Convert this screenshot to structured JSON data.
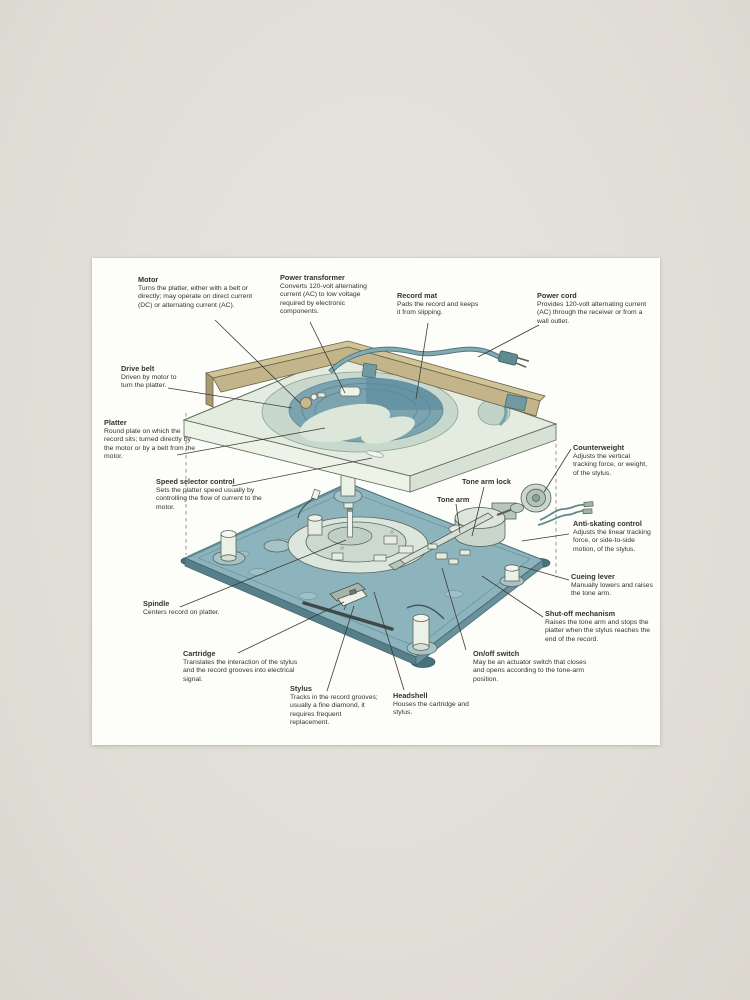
{
  "scene": {
    "type": "photographic print of a labeled diagram",
    "background_color": "#e2dfd8",
    "paper_color": "#fdfdf9"
  },
  "diagram": {
    "subject": "turntable exploded-view diagram",
    "palette": {
      "cabinet_tan": "#c9bc92",
      "deck_mint": "#e4ecdf",
      "platter_mat_teal": "#7ba3b0",
      "base_plate_teal": "#8db4bc",
      "leader_line": "#3c3c35"
    },
    "labels": [
      {
        "id": "motor",
        "title": "Motor",
        "description": "Turns the platter, either with a belt or directly; may operate on direct current (DC) or alternating current (AC)."
      },
      {
        "id": "power-transformer",
        "title": "Power transformer",
        "description": "Converts 120-volt alternating current (AC) to low voltage required by electronic components."
      },
      {
        "id": "record-mat",
        "title": "Record mat",
        "description": "Pads the record and keeps it from slipping."
      },
      {
        "id": "power-cord",
        "title": "Power cord",
        "description": "Provides 120-volt alternating current (AC) through the receiver or from a wall outlet."
      },
      {
        "id": "drive-belt",
        "title": "Drive belt",
        "description": "Driven by motor to turn the platter."
      },
      {
        "id": "platter",
        "title": "Platter",
        "description": "Round plate on which the record sits; turned directly by the motor or by a belt from the motor."
      },
      {
        "id": "speed-selector-control",
        "title": "Speed selector control",
        "description": "Sets the platter speed usually by controlling the flow of current to the motor."
      },
      {
        "id": "counterweight",
        "title": "Counterweight",
        "description": "Adjusts the vertical tracking force, or weight, of the stylus."
      },
      {
        "id": "tone-arm-lock",
        "title": "Tone arm lock",
        "description": ""
      },
      {
        "id": "tone-arm",
        "title": "Tone arm",
        "description": ""
      },
      {
        "id": "anti-skating-control",
        "title": "Anti-skating control",
        "description": "Adjusts the linear tracking force, or side-to-side motion, of the stylus."
      },
      {
        "id": "cueing-lever",
        "title": "Cueing lever",
        "description": "Manually lowers and raises the tone arm."
      },
      {
        "id": "spindle",
        "title": "Spindle",
        "description": "Centers record on platter."
      },
      {
        "id": "shut-off-mechanism",
        "title": "Shut-off mechanism",
        "description": "Raises the tone arm and stops the platter when the stylus reaches the end of the record."
      },
      {
        "id": "cartridge",
        "title": "Cartridge",
        "description": "Translates the interaction of the stylus and the record grooves into electrical signal."
      },
      {
        "id": "on-off-switch",
        "title": "On/off switch",
        "description": "May be an actuator switch that closes and opens according to the tone-arm position."
      },
      {
        "id": "stylus",
        "title": "Stylus",
        "description": "Tracks in the record grooves; usually a fine diamond, it requires frequent replacement."
      },
      {
        "id": "headshell",
        "title": "Headshell",
        "description": "Houses the cartridge and stylus."
      }
    ]
  }
}
